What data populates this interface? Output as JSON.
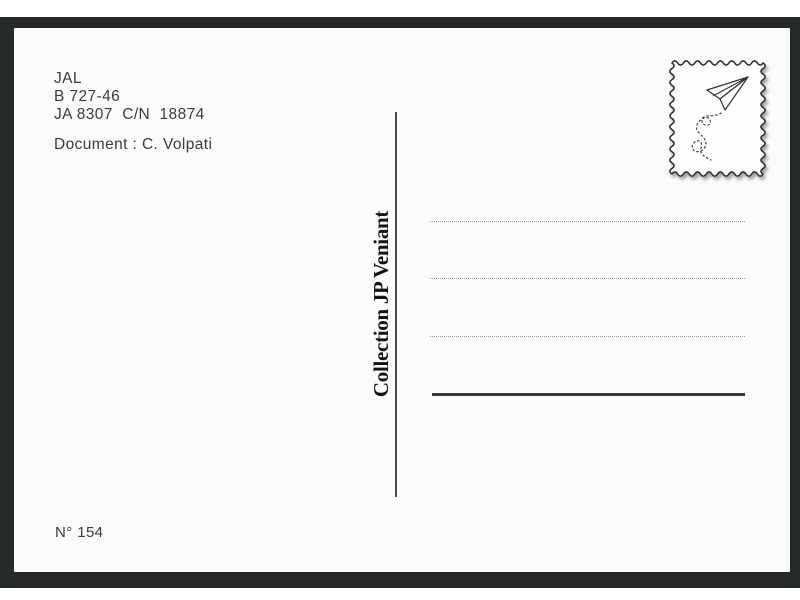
{
  "postcard": {
    "sender": {
      "lines": [
        "JAL",
        "B 727-46",
        "JA 8307  C/N  18874"
      ],
      "document_line": "Document : C. Volpati"
    },
    "collection_label": "Collection JP Veniant",
    "number_label": "N° 154",
    "stamp": {
      "icon": "paper-plane-icon",
      "style": "wavy-border-stamp-box"
    },
    "address_area": {
      "dotted_line_count": 3,
      "solid_line_count": 1
    },
    "colors": {
      "matte": "#272b27",
      "card": "#fbfafc",
      "ink": "#3c3c3c",
      "collection_ink": "#141414",
      "rule": "#3a3a3a",
      "dotted_rule": "#9b9b9b"
    }
  }
}
